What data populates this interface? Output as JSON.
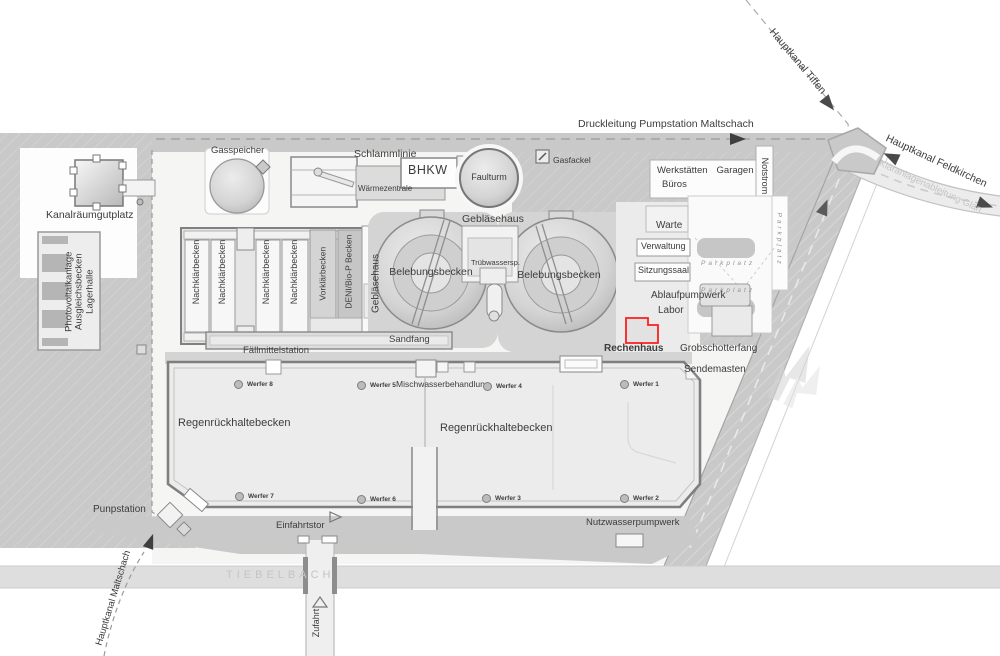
{
  "pipelines": {
    "druckleitung": "Druckleitung Pumpstation Maltschach",
    "hauptkanal_tiffen": "Hauptkanal Tiffen",
    "hauptkanal_feldkirchen": "Hauptkanal Feldkirchen",
    "klaeranlagenableitung": "Kläranlagenableitung Glan",
    "hauptkanal_maltschach": "Hauptkanal Maltschach"
  },
  "sludge_line": {
    "gasspeicher": "Gasspeicher",
    "schlammlinie": "Schlammlinie",
    "waermezentrale": "Wärmezentrale",
    "bhkw": "BHKW",
    "faulturm": "Faulturm",
    "gasfackel": "Gasfackel"
  },
  "west_area": {
    "kanalraeumgutplatz": "Kanalräumgutplatz",
    "photovoltaik_lines": [
      "Photovoltaikanlage",
      "Ausgleichsbecken",
      "Lagerhalle"
    ],
    "pumpstation": "Punpstation"
  },
  "treatment": {
    "nachklaerbecken": "Nachklärbecken",
    "vorklaerbecken": "Vorklärbecken",
    "denibio_becken": "DENI/Bio-P Becken",
    "geblaesehaus": "Gebläsehaus",
    "belebungsbecken": "Belebungsbecken",
    "truebwassersp": "Trübwassersp.",
    "sandfang": "Sandfang",
    "faellmittelstation": "Fällmittelstation"
  },
  "buildings": {
    "werkstaetten": "Werkstätten",
    "garagen": "Garagen",
    "bueros": "Büros",
    "notstrom": "Notstrom",
    "warte": "Warte",
    "verwaltung": "Verwaltung",
    "sitzungssaal": "Sitzungssaal",
    "parkplatz": "Parkplatz",
    "ablaufpumpwerk": "Ablaufpumpwerk",
    "labor": "Labor",
    "rechenhaus": "Rechenhaus",
    "grobschotterfang": "Grobschotterfang",
    "sendemasten": "Sendemasten"
  },
  "storm": {
    "mischwasserbehandlung": "Mischwasserbehandlung",
    "regenrueckhaltebecken": "Regenrückhaltebecken",
    "werfer": [
      "Werfer 1",
      "Werfer 2",
      "Werfer 3",
      "Werfer 4",
      "Werfer 5",
      "Werfer 6",
      "Werfer 7",
      "Werfer 8"
    ]
  },
  "south": {
    "einfahrtstor": "Einfahrtstor",
    "nutzwasserpumpwerk": "Nutzwasserpumpwerk",
    "zufahrt": "Zufahrt",
    "tiebelbach": "TIEBELBACH"
  },
  "colors": {
    "highlight_red": "#ff1e1e",
    "area_gray": "#c9c9c9",
    "site_light": "#f5f5f4"
  }
}
